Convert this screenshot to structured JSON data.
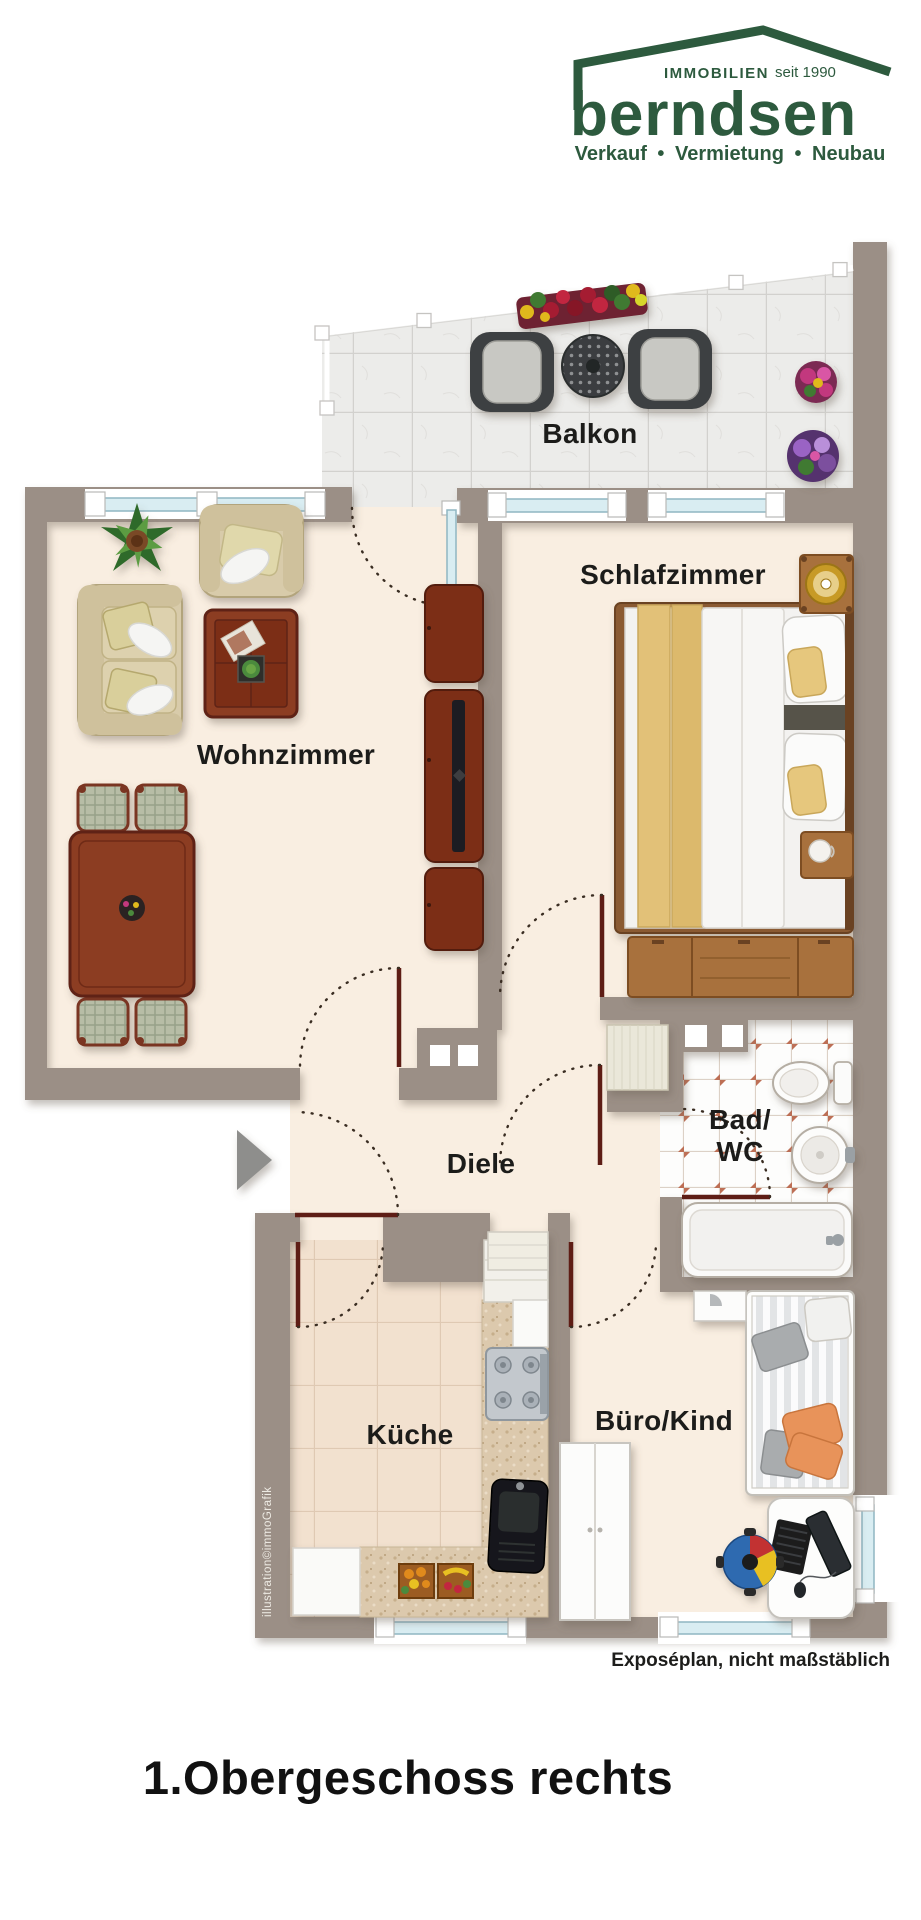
{
  "logo": {
    "immobilien": "IMMOBILIEN",
    "since": "seit 1990",
    "brand": "berndsen",
    "tagline": "Verkauf • Vermietung • Neubau"
  },
  "rooms": {
    "balkon": "Balkon",
    "schlafzimmer": "Schlafzimmer",
    "wohnzimmer": "Wohnzimmer",
    "diele": "Diele",
    "bad_line1": "Bad/",
    "bad_line2": "WC",
    "kueche": "Küche",
    "buero": "Büro/Kind"
  },
  "caption": "Exposéplan, nicht maßstäblich",
  "title": "1.Obergeschoss rechts",
  "credit": "illustration©immoGrafik",
  "colors": {
    "logo_green": "#2d5a3e",
    "wall": "#9b8f86",
    "floor": "#f9eee1",
    "door": "#5e1d15",
    "window_glass": "#d9edf2",
    "bath_accent": "#bd6f55"
  }
}
